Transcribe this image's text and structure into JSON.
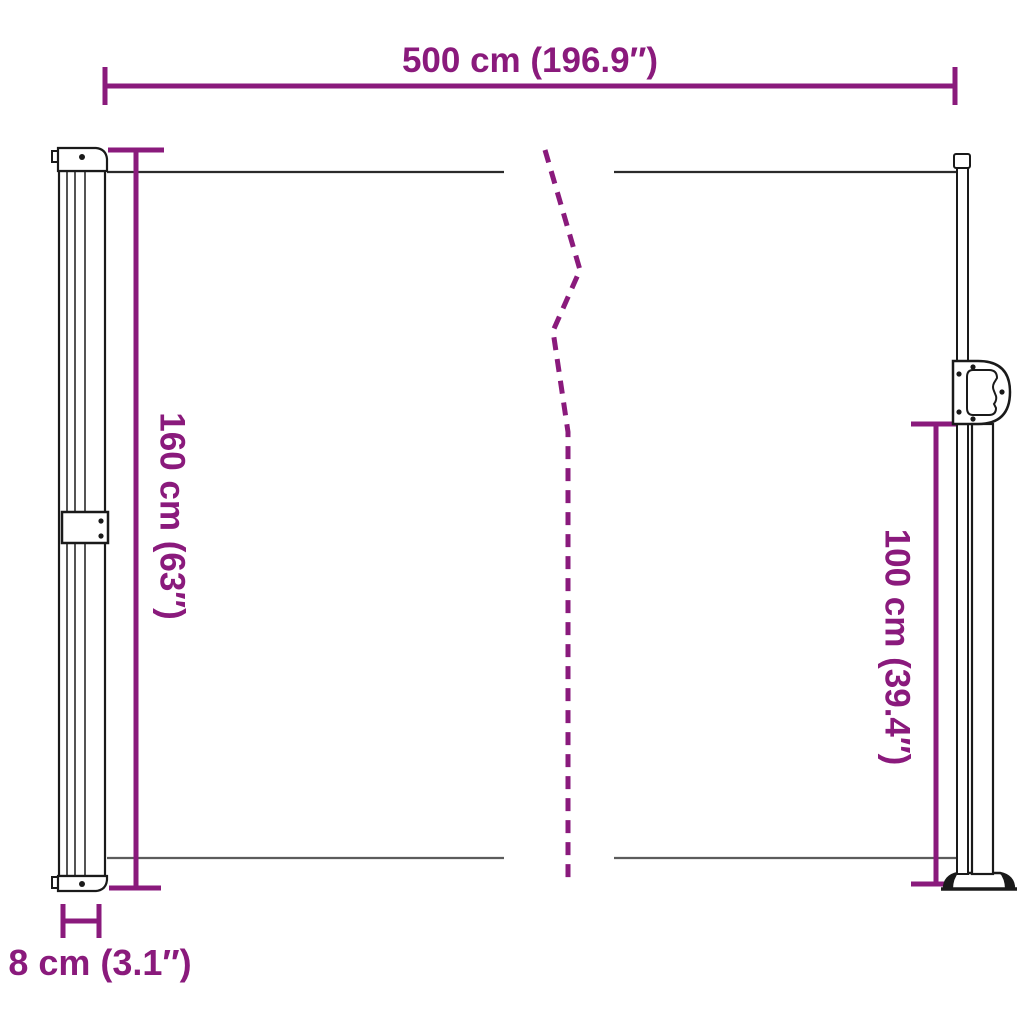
{
  "colors": {
    "dimension": "#8A1A7C",
    "outline": "#1a1a1a"
  },
  "diagram": {
    "kind": "retractable-side-awning-dimension-diagram",
    "labels": {
      "width_total": "500 cm (196.9″)",
      "height_left": "160 cm (63″)",
      "height_right": "100 cm (39.4″)",
      "cassette_depth": "8 cm (3.1″)"
    },
    "values": {
      "width_cm": 500,
      "width_in": 196.9,
      "height_cm": 160,
      "height_in": 63,
      "post_height_cm": 100,
      "post_height_in": 39.4,
      "depth_cm": 8,
      "depth_in": 3.1
    }
  }
}
